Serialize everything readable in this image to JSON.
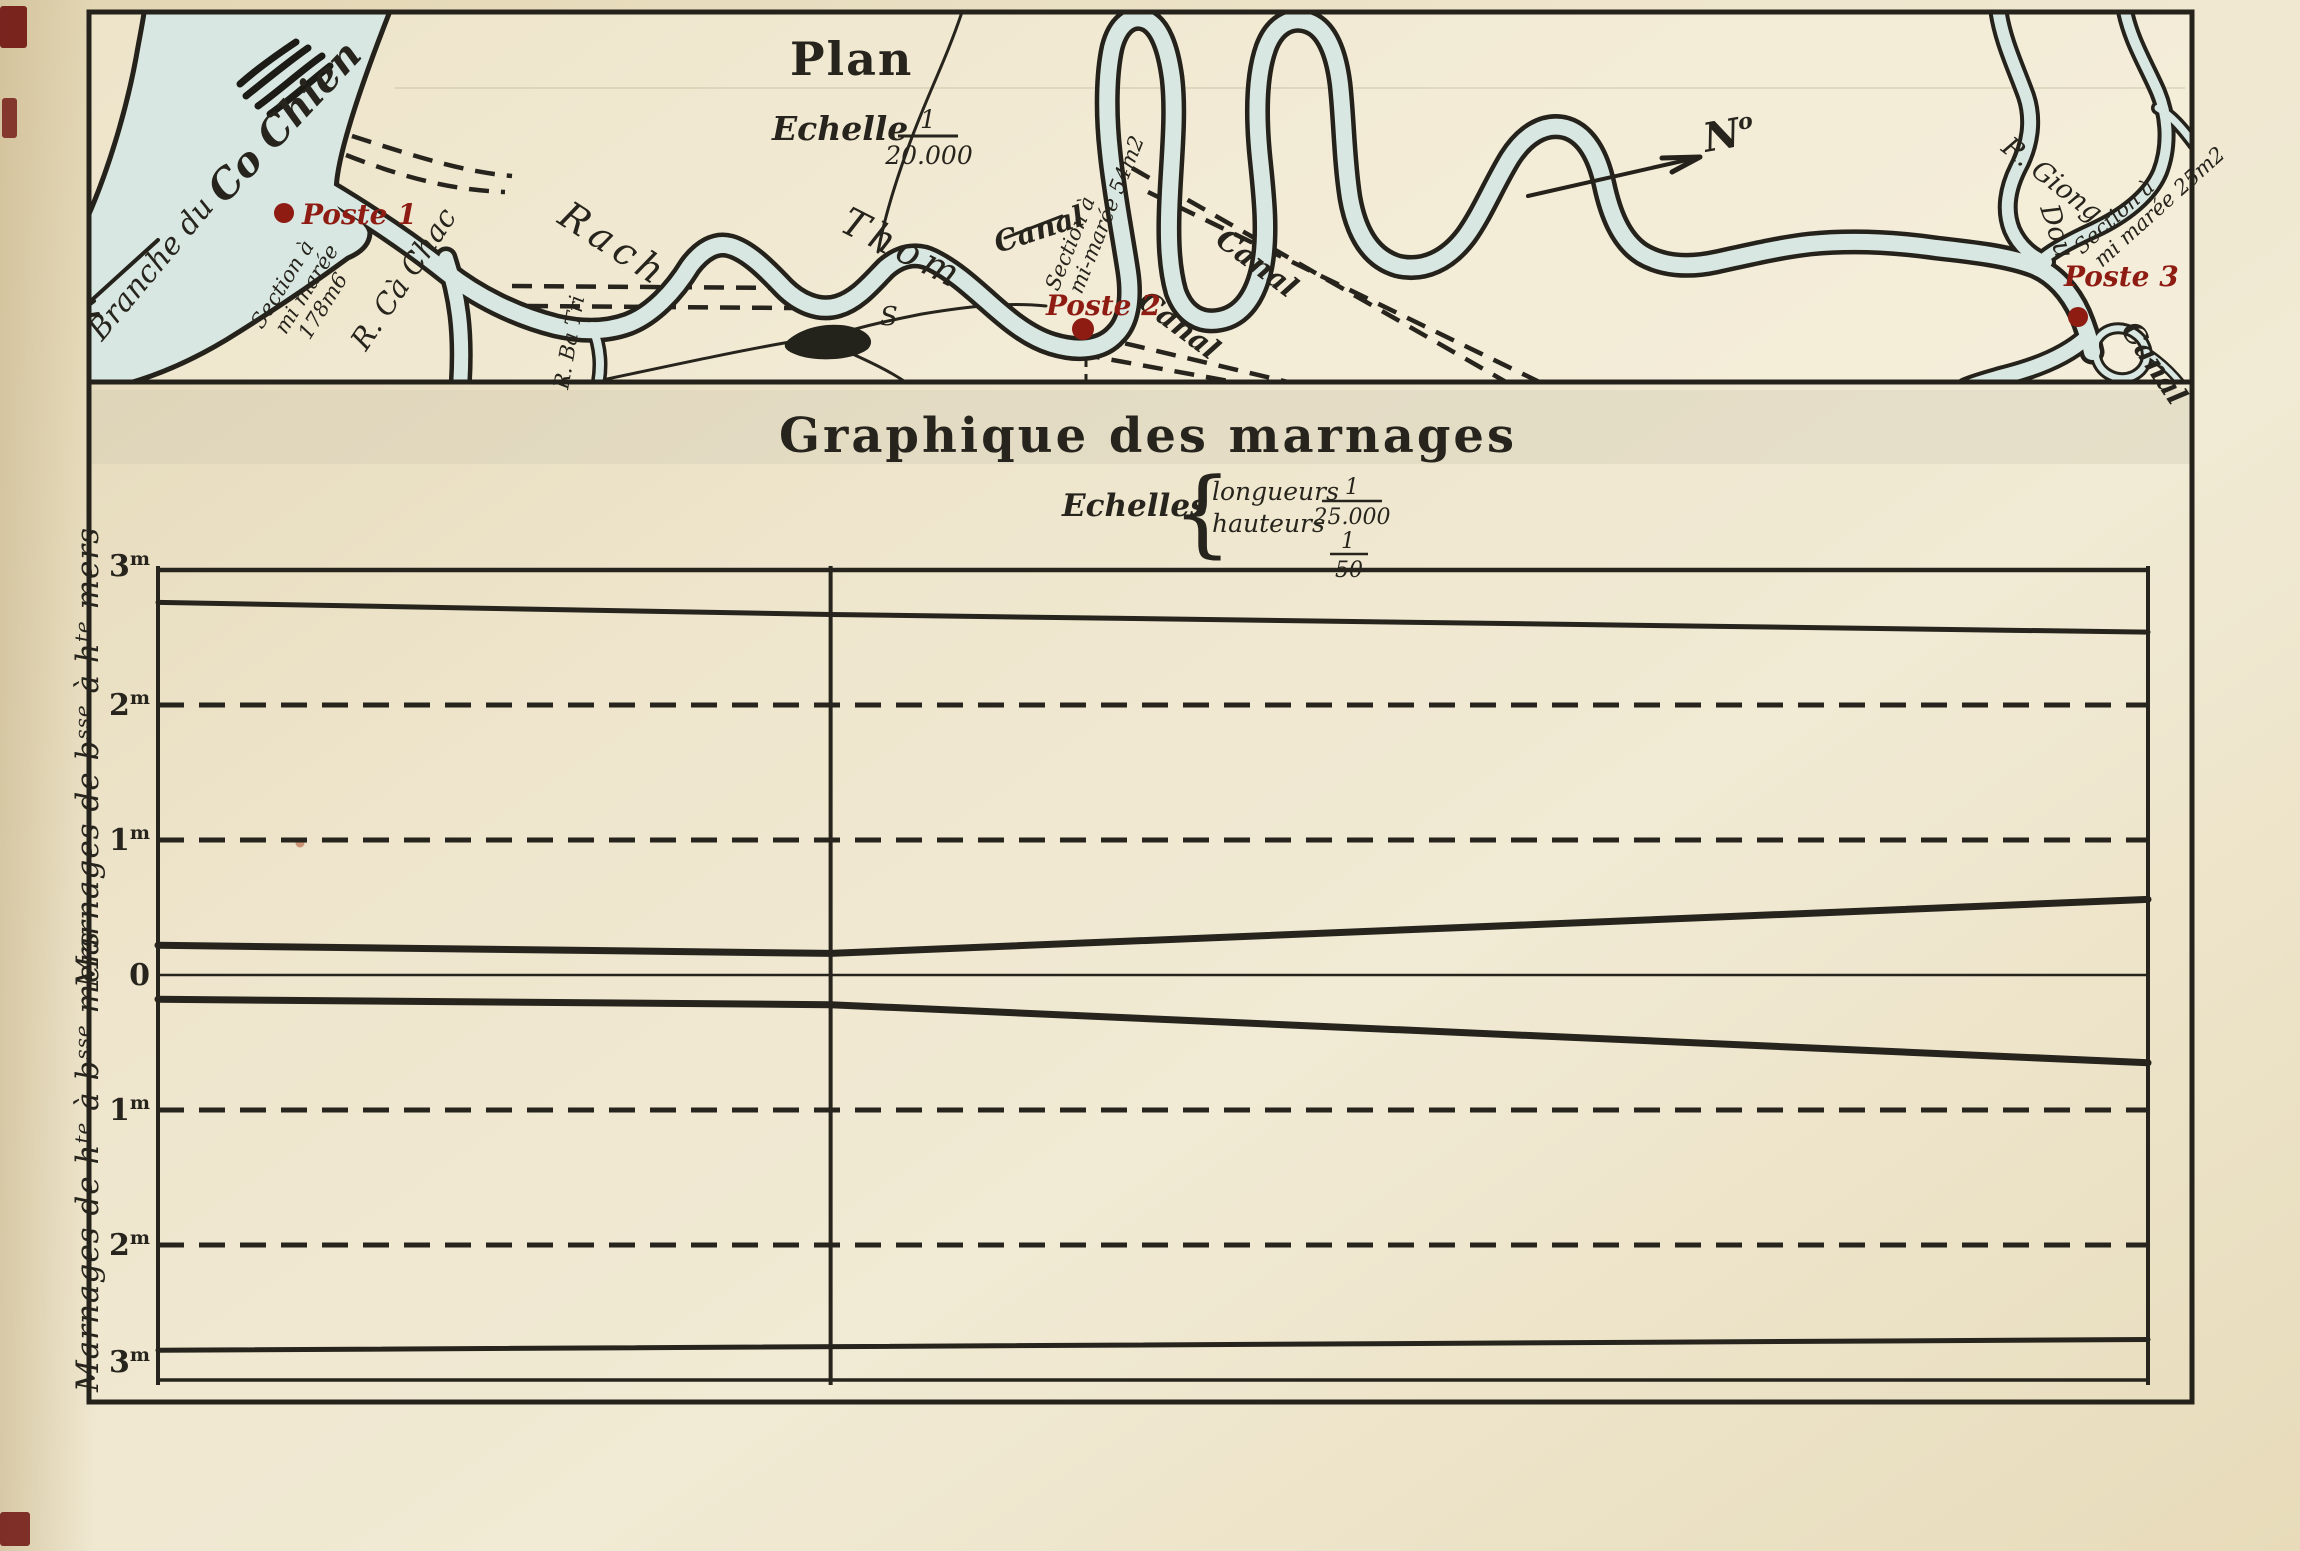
{
  "palette": {
    "paper": "#efe7cf",
    "ink": "#26241c",
    "river": "#d8e7e1",
    "red": "#8e1c13"
  },
  "map": {
    "title": "Plan",
    "scale_label": "Echelle",
    "scale_num": "1",
    "scale_den": "20.000",
    "north": "N",
    "north_flourish": "o",
    "labels": {
      "branche": "Branche du",
      "cochien": "Co Chien",
      "rach": "Rach",
      "thom": "Thom",
      "cachac": "R. Cà Chac",
      "batri": "R. Ba Tri",
      "giong": "R. Giong",
      "giong2": "Dou",
      "island_s": "S",
      "canal1": "Canal",
      "canal2": "Canal",
      "canal3": "Canal",
      "canal4": "Canal"
    },
    "posts": [
      {
        "label": "Poste 1",
        "s1": "Section à",
        "s2": "mi marée",
        "s3": "178m6"
      },
      {
        "label": "Poste 2",
        "s1": "Section à",
        "s2": "mi-marée 54m2"
      },
      {
        "label": "Poste 3",
        "s1": "Section à",
        "s2": "mi marée 25m2"
      }
    ]
  },
  "chart_data": {
    "type": "line",
    "title": "Graphique des marnages",
    "scales": {
      "label": "Echelles",
      "longueurs_label": "longueurs",
      "longueurs_num": "1",
      "longueurs_den": "25.000",
      "hauteurs_label": "hauteurs",
      "hauteurs_num": "1",
      "hauteurs_den": "50"
    },
    "x_axis": {
      "tick_labels": [],
      "range": [
        0,
        1
      ],
      "divider_x_fraction": 0.338,
      "note": "vertical rule at Poste 2 position, no x tick labels shown"
    },
    "panels": [
      {
        "axis_label_plain": "Marnages de bsse à hte mers",
        "axis_label_parts": {
          "p1": "Marnages de b",
          "s1": "sse",
          "p2": " à h",
          "s2": "te",
          "p3": " mers"
        },
        "direction": "up",
        "ylim_m": [
          0,
          3
        ],
        "ticks": [
          {
            "v": "3",
            "u": "m"
          },
          {
            "v": "2",
            "u": "m"
          },
          {
            "v": "1",
            "u": "m"
          },
          {
            "v": "0",
            "u": ""
          }
        ],
        "dashed_gridlines_m": [
          2,
          1
        ],
        "series": [
          {
            "name": "upper-envelope-line",
            "thick": false,
            "points_xfrac_m": [
              [
                0,
                2.76
              ],
              [
                0.338,
                2.67
              ],
              [
                1,
                2.54
              ]
            ]
          },
          {
            "name": "rising-tide-marnage",
            "thick": true,
            "points_xfrac_m": [
              [
                0,
                0.22
              ],
              [
                0.338,
                0.16
              ],
              [
                1,
                0.56
              ]
            ]
          }
        ]
      },
      {
        "axis_label_plain": "Marnages de hte à bsse mers",
        "axis_label_parts": {
          "p1": "Marnages de h",
          "s1": "te",
          "p2": " à b",
          "s2": "sse",
          "p3": " mers"
        },
        "direction": "down",
        "ylim_m": [
          0,
          3
        ],
        "ticks": [
          {
            "v": "1",
            "u": "m"
          },
          {
            "v": "2",
            "u": "m"
          },
          {
            "v": "3",
            "u": "m"
          }
        ],
        "dashed_gridlines_m": [
          1,
          2
        ],
        "series": [
          {
            "name": "falling-tide-marnage",
            "thick": true,
            "points_xfrac_m": [
              [
                0,
                0.18
              ],
              [
                0.338,
                0.22
              ],
              [
                1,
                0.65
              ]
            ]
          },
          {
            "name": "lower-envelope-line",
            "thick": false,
            "points_xfrac_m": [
              [
                0,
                2.78
              ],
              [
                1,
                2.7
              ]
            ]
          }
        ]
      }
    ],
    "zero_line_m": 0
  }
}
